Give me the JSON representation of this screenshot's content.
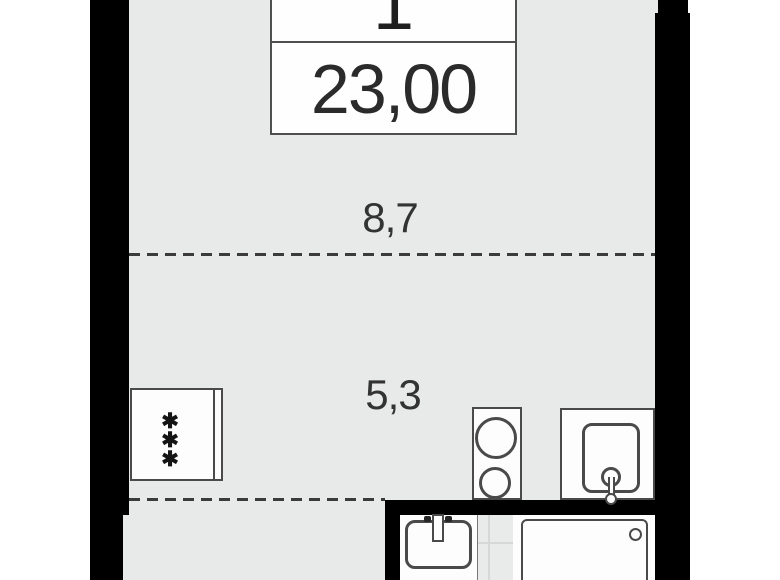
{
  "floor_plan": {
    "unit_card": {
      "unit_number": "1",
      "area_value": "23,00"
    },
    "room_dimensions": {
      "upper_zone": "8,7",
      "lower_zone": "5,3"
    },
    "appliance_symbol": "✱\n✱\n✱",
    "colors": {
      "background": "#ffffff",
      "wall": "#000000",
      "floor": "#e8eaea",
      "bathroom_floor": "#e9ebeb",
      "fixture_fill": "#fdfdfd",
      "fixture_border": "#4a4a4a",
      "dashed_line": "#3b3b3b",
      "text": "#2f2f2f"
    }
  }
}
